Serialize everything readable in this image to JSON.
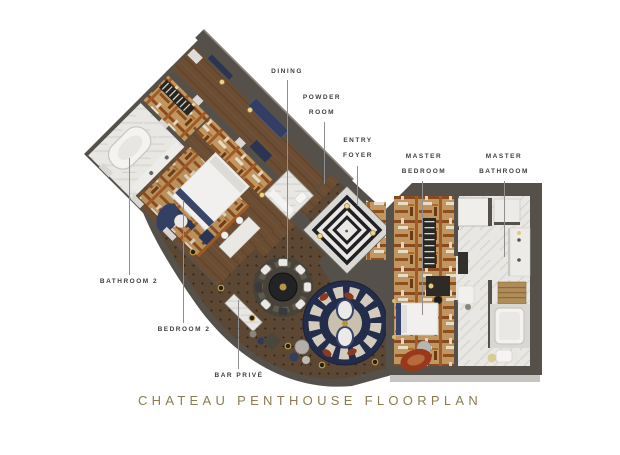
{
  "title": "CHATEAU PENTHOUSE FLOORPLAN",
  "rooms": {
    "dining": {
      "label": "DINING"
    },
    "powder_room": {
      "line1": "POWDER",
      "line2": "ROOM"
    },
    "entry_foyer": {
      "line1": "ENTRY",
      "line2": "FOYER"
    },
    "master_bedroom": {
      "line1": "MASTER",
      "line2": "BEDROOM"
    },
    "master_bathroom": {
      "line1": "MASTER",
      "line2": "BATHROOM"
    },
    "bathroom_2": {
      "label": "BATHROOM 2"
    },
    "bedroom_2": {
      "label": "BEDROOM 2"
    },
    "bar_prive": {
      "label": "BAR PRIVÉ"
    }
  },
  "colors": {
    "title_gold": "#8b7c50",
    "label_text": "#3e3e3e",
    "leader_line": "#8f8f8f",
    "wall": "#55514a",
    "wood_floor": "#6b4d33",
    "parquet_floor": "#5b4733",
    "marble": "#e8e7e3",
    "rust_accent": "#a25a26",
    "navy_accent": "#2e3a5c",
    "gold_accent": "#c9a14e"
  }
}
